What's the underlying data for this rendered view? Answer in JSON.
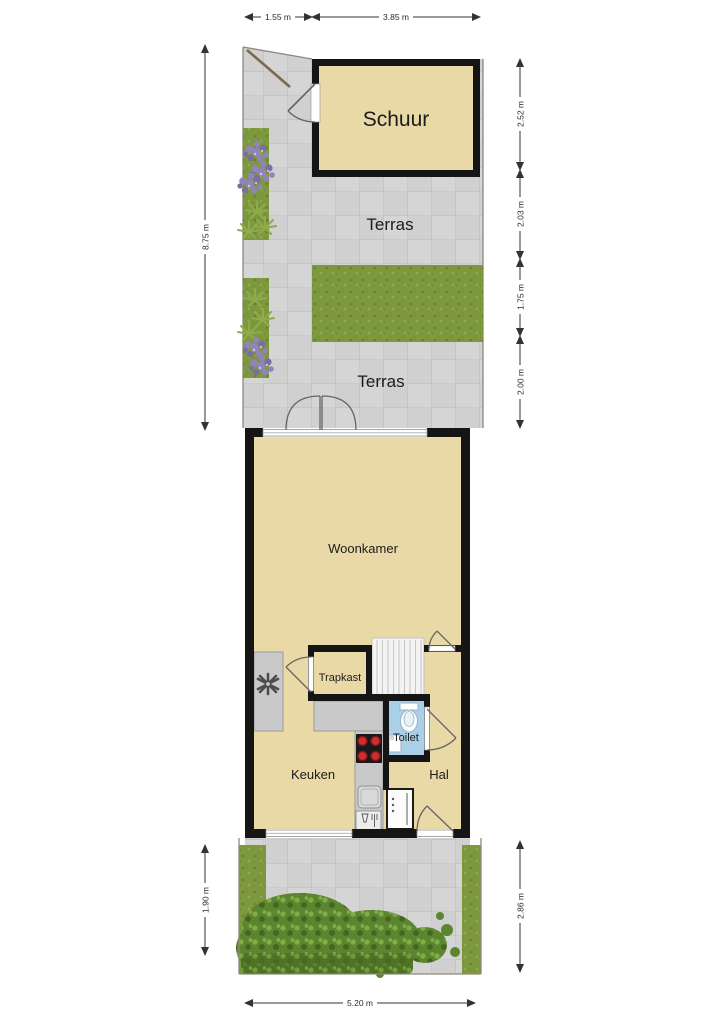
{
  "plan": {
    "rooms": {
      "schuur": "Schuur",
      "terras_upper": "Terras",
      "terras_lower": "Terras",
      "woonkamer": "Woonkamer",
      "trapkast": "Trapkast",
      "toilet": "Toilet",
      "keuken": "Keuken",
      "hal": "Hal"
    },
    "dims": {
      "top": [
        "1.55 m",
        "3.85 m"
      ],
      "left": [
        "8.75 m"
      ],
      "right": [
        "2.52 m",
        "2.03 m",
        "1.75 m",
        "2.00 m"
      ],
      "bottom_left": [
        "1.90 m"
      ],
      "bottom_right": [
        "2.86 m"
      ],
      "bottom": [
        "5.20 m"
      ]
    },
    "colors": {
      "wall": "#151515",
      "floor": "#e9d9a7",
      "terrace": "#d3d3d3",
      "tile_line": "#c3c3c3",
      "grass": "#7d983e",
      "grass_dark": "#69832f",
      "grass_light": "#8fac4b",
      "bed": "#6d9135",
      "bush": "#5c8530",
      "bush_dark": "#44661e",
      "bush_light": "#82ad46",
      "hedge": "#4f7326",
      "flower": "#9184b8",
      "flower_dark": "#7b6fa0",
      "toilet_floor": "#a9cfe9",
      "fixture_stroke": "#98b3c6",
      "counter": "#c9c9c9",
      "counter_border": "#9a9a9a",
      "stove": "#191919",
      "burner": "#c92f2f",
      "stairs": "#f3f3f3",
      "stair_line": "#c6c6c6",
      "door_stroke": "#666666",
      "dim": "#333333",
      "boundary": "#8d8a79",
      "gate": "#7b6a4e"
    }
  }
}
